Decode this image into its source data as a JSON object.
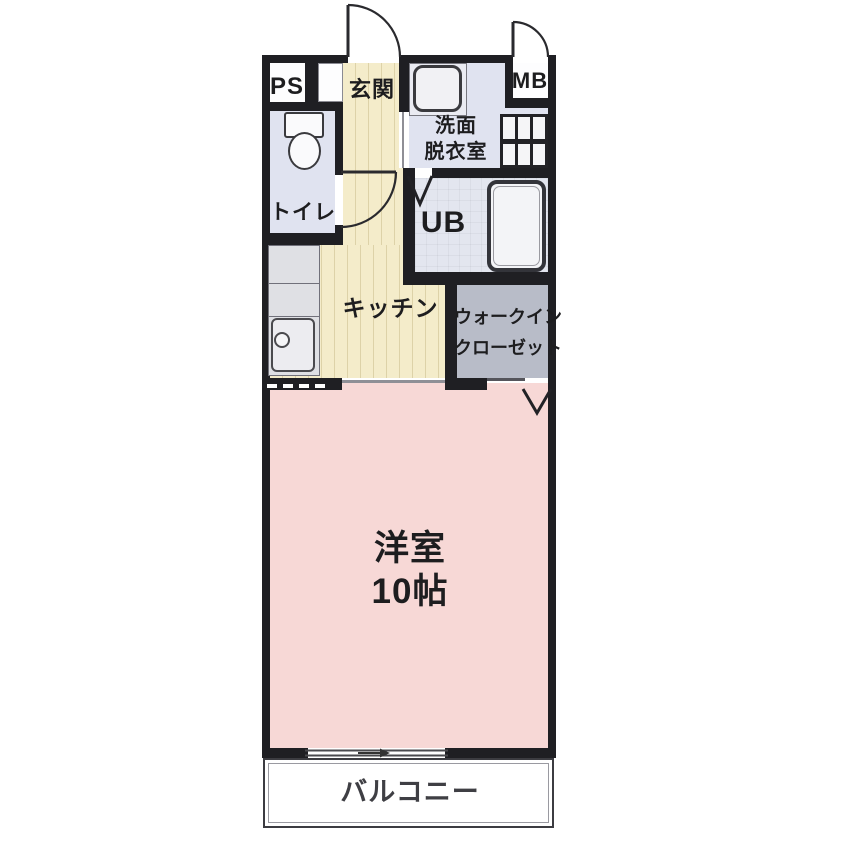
{
  "colors": {
    "wall": "#1f1f23",
    "flooring": "#f4ecca",
    "flooring_stripe": "#ddd2a8",
    "wet_room": "#e0e3f0",
    "unit_bath": "#e3e6ef",
    "closet": "#b8bcc8",
    "bedroom": "#f7d8d6",
    "counter": "#dfe0e4",
    "balcony": "#ffffff",
    "label": "#1d1d1f"
  },
  "rooms": {
    "ps": {
      "label": "PS"
    },
    "entrance": {
      "label": "玄関"
    },
    "meter_box": {
      "label": "MB"
    },
    "washroom": {
      "label_line1": "洗面",
      "label_line2": "脱衣室"
    },
    "toilet": {
      "label": "トイレ"
    },
    "unit_bath": {
      "label": "UB"
    },
    "kitchen": {
      "label": "キッチン"
    },
    "walk_in_closet": {
      "label_line1": "ウォークイン",
      "label_line2": "クローゼット"
    },
    "western_room": {
      "label_line1": "洋室",
      "label_line2": "10帖"
    },
    "balcony": {
      "label": "バルコニー"
    }
  }
}
